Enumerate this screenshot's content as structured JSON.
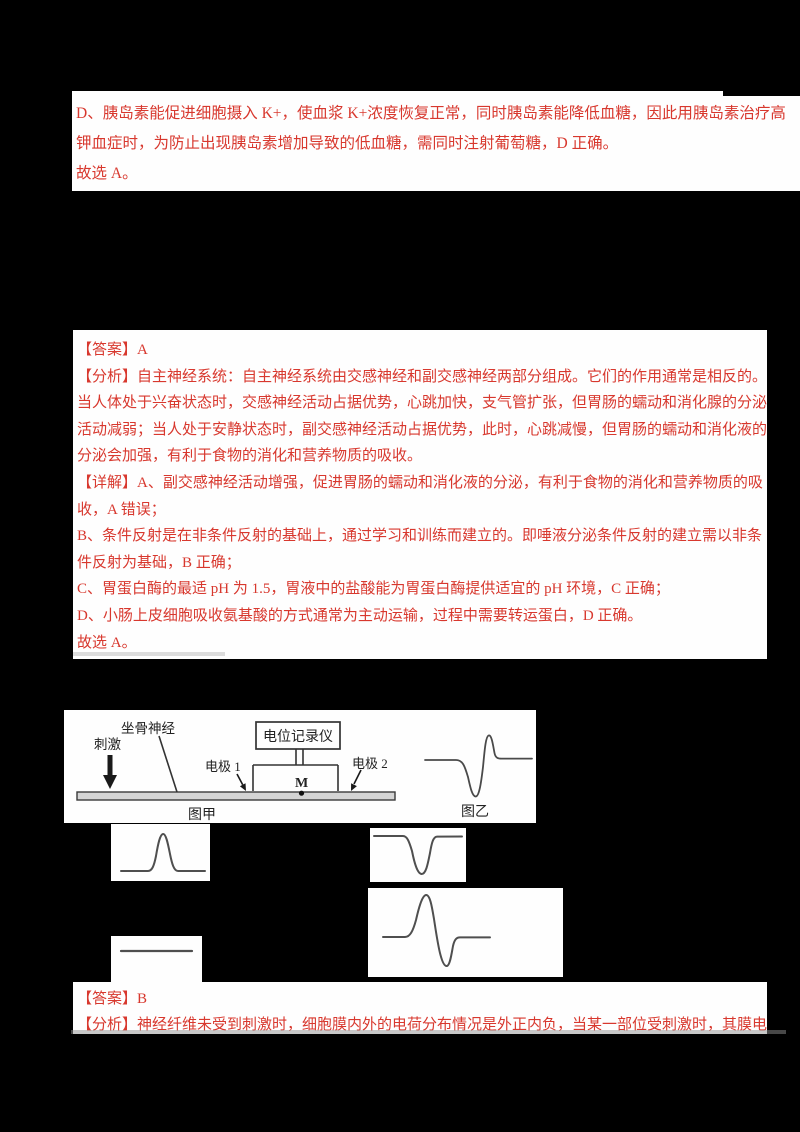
{
  "page": {
    "background": "#000000",
    "paper_color": "#fefefe",
    "text_color_red": "#d8382e",
    "diagram_ink": "#3a3a3a"
  },
  "block1": {
    "lines": [
      "D、胰岛素能促进细胞摄入 K+，使血浆 K+浓度恢复正常，同时胰岛素能降低血糖，因此用胰岛素治疗高",
      "钾血症时，为防止出现胰岛素增加导致的低血糖，需同时注射葡萄糖，D 正确。",
      "故选 A。"
    ]
  },
  "block2": {
    "lines": [
      "【答案】A",
      "【分析】自主神经系统：自主神经系统由交感神经和副交感神经两部分组成。它们的作用通常是相反的。",
      "当人体处于兴奋状态时，交感神经活动占据优势，心跳加快，支气管扩张，但胃肠的蠕动和消化腺的分泌",
      "活动减弱；当人处于安静状态时，副交感神经活动占据优势，此时，心跳减慢，但胃肠的蠕动和消化液的",
      "分泌会加强，有利于食物的消化和营养物质的吸收。",
      "【详解】A、副交感神经活动增强，促进胃肠的蠕动和消化液的分泌，有利于食物的消化和营养物质的吸",
      "收，A 错误；",
      "B、条件反射是在非条件反射的基础上，通过学习和训练而建立的。即唾液分泌条件反射的建立需以非条",
      "件反射为基础，B 正确；",
      "C、胃蛋白酶的最适 pH 为 1.5，胃液中的盐酸能为胃蛋白酶提供适宜的 pH 环境，C 正确；",
      "D、小肠上皮细胞吸收氨基酸的方式通常为主动运输，过程中需要转运蛋白，D 正确。",
      "故选 A。"
    ]
  },
  "diagram": {
    "stimulus_label": "刺激",
    "nerve_label": "坐骨神经",
    "recorder_label": "电位记录仪",
    "electrode1_label": "电极 1",
    "electrode2_label": "电极 2",
    "point_label": "M",
    "figure_a_label": "图甲",
    "figure_b_label": "图乙",
    "figure_b_waveform": "biphasic-down-then-up"
  },
  "option_waveforms": {
    "wave1": "single-upward-peak",
    "wave2": "single-downward-trough",
    "wave3": "flat-line",
    "wave4": "biphasic-up-then-down"
  },
  "block4": {
    "lines": [
      "【答案】B",
      "【分析】神经纤维未受到刺激时，细胞膜内外的电荷分布情况是外正内负，当某一部位受刺激时，其膜电"
    ]
  }
}
